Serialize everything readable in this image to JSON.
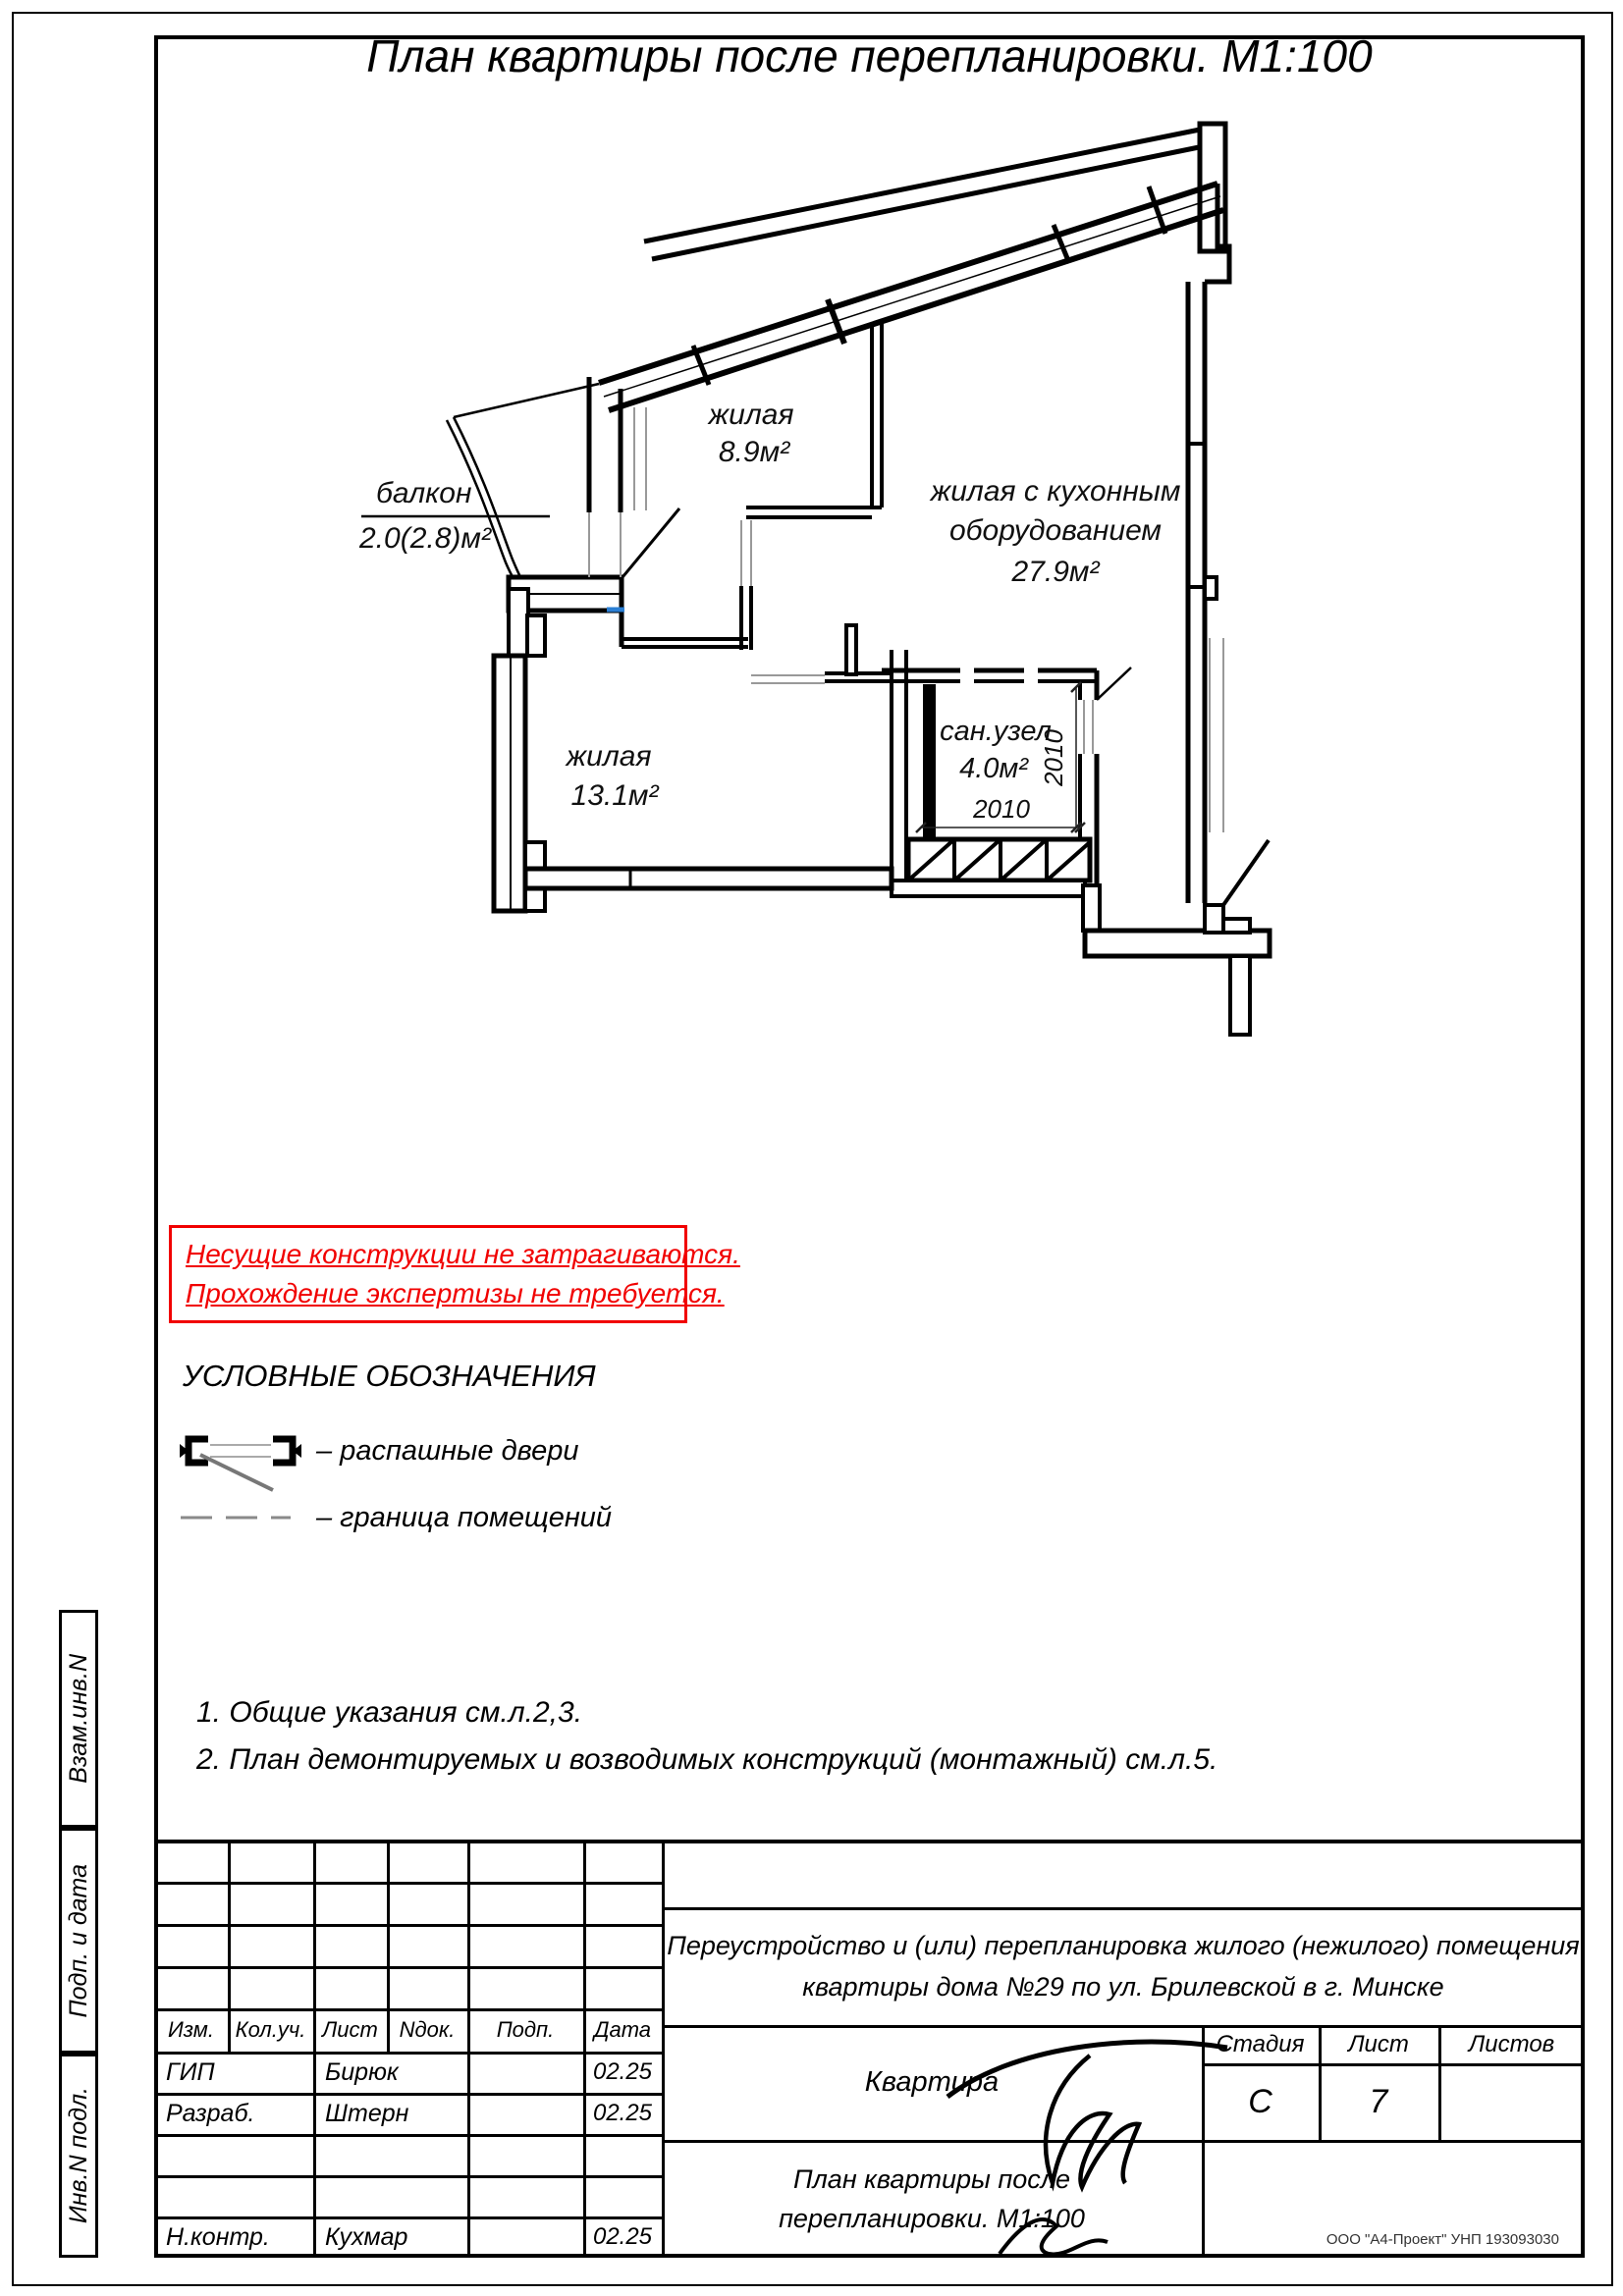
{
  "page": {
    "title": "План квартиры после перепланировки. М1:100"
  },
  "plan": {
    "rooms": [
      {
        "name": "жилая",
        "area": "8.9м²"
      },
      {
        "name_line1": "жилая с кухонным",
        "name_line2": "оборудованием",
        "area": "27.9м²"
      },
      {
        "name": "жилая",
        "area": "13.1м²"
      },
      {
        "name": "сан.узел",
        "area": "4.0м²"
      }
    ],
    "balcony": {
      "name": "балкон",
      "area": "2.0(2.8)м²"
    },
    "dimensions": {
      "san_width": "2010",
      "san_door": "2010"
    }
  },
  "warning": {
    "color": "#f10000",
    "lines": [
      "Несущие конструкции не затрагиваются.",
      "Прохождение экспертизы не требуется."
    ]
  },
  "legend": {
    "heading": "УСЛОВНЫЕ ОБОЗНАЧЕНИЯ",
    "items": [
      {
        "label": "– распашные двери"
      },
      {
        "label": "– граница помещений"
      }
    ]
  },
  "notes": [
    "1. Общие указания см.л.2,3.",
    "2. План демонтируемых и возводимых конструкций (монтажный) см.л.5."
  ],
  "sidebar": {
    "labels": [
      "Взам.инв.N",
      "Подп. и дата",
      "Инв.N подл."
    ]
  },
  "titleblock": {
    "header_cols": [
      "Изм.",
      "Кол.уч.",
      "Лист",
      "Nдок.",
      "Подп.",
      "Дата"
    ],
    "rows": [
      {
        "role": "ГИП",
        "name": "Бирюк",
        "date": "02.25"
      },
      {
        "role": "Разраб.",
        "name": "Штерн",
        "date": "02.25"
      },
      {
        "role": "",
        "name": "",
        "date": ""
      },
      {
        "role": "",
        "name": "",
        "date": ""
      },
      {
        "role": "Н.контр.",
        "name": "Кухмар",
        "date": "02.25"
      }
    ],
    "project": {
      "line1": "Переустройство и (или) перепланировка жилого (нежилого) помещения",
      "line2": "квартиры дома №29 по ул. Брилевской в г. Минске"
    },
    "object": "Квартира",
    "stage_label": "Стадия",
    "sheet_label": "Лист",
    "sheets_label": "Листов",
    "stage": "С",
    "sheet": "7",
    "sheets": "",
    "drawing_title": {
      "line1": "План квартиры после",
      "line2": "перепланировки. М1:100"
    },
    "org": "ООО \"А4-Проект\" УНП 193093030"
  },
  "colors": {
    "warning_red": "#f10000",
    "snap_blue": "#2b7fd4",
    "boundary_gray": "#999999"
  }
}
